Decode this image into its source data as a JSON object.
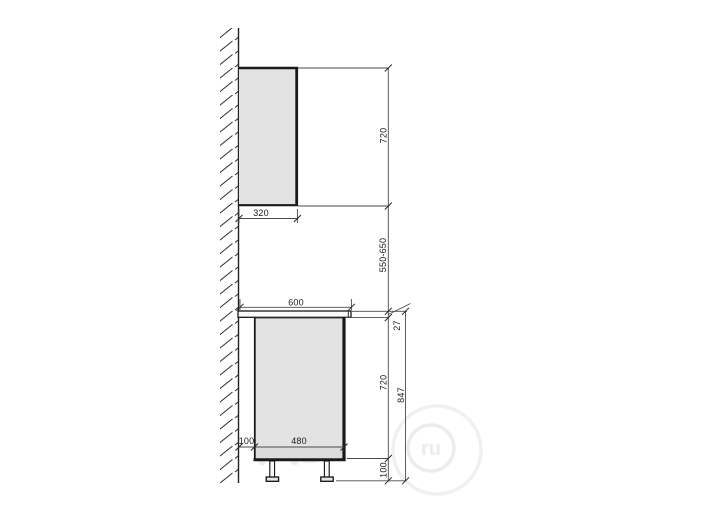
{
  "drawing": {
    "subject": "kitchen-cabinet-side-elevation",
    "dims": {
      "wall_cabinet_height": "720",
      "wall_cabinet_depth": "320",
      "hang_gap": "550-650",
      "countertop_depth": "600",
      "countertop_thickness": "27",
      "base_cabinet_height": "720",
      "total_height": "847",
      "base_cabinet_depth": "480",
      "wall_clearance": "100",
      "leg_height": "100"
    },
    "watermark": {
      "domain": "ru"
    },
    "colors": {
      "outline": "#1a1a1a",
      "dimension_line": "#4a4a4a",
      "cabinet_fill": "#e3e3e3",
      "plinth_strip_fill": "#dcdcdc",
      "countertop_fill": "#fafafa",
      "watermark": "#ebebeb",
      "background": "#ffffff"
    }
  }
}
